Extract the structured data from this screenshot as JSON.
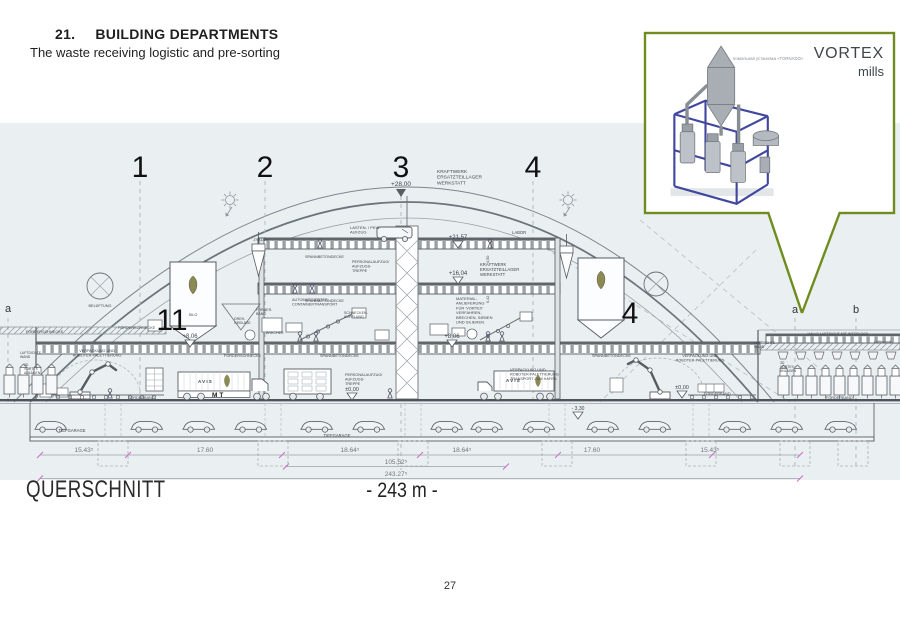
{
  "header": {
    "section_number": "21.",
    "title": "BUILDING DEPARTMENTS",
    "subtitle": "The waste receiving logistic and pre-sorting"
  },
  "inset": {
    "caption": "помольная установка «TORNADO»",
    "brand": "VORTEX",
    "brand_sub": "mills"
  },
  "titles": {
    "drawing_title": "QUERSCHNITT",
    "span_label": "- 243 m -"
  },
  "footer": {
    "page_number": "27"
  },
  "colors": {
    "callout_green": "#6f8d1f",
    "band_blue": "#eaeff2",
    "frame_blue": "#41479e",
    "tick_magenta": "#c96fc9"
  },
  "drawing": {
    "grid_labels": [
      {
        "t": "1",
        "x": 140,
        "y": 177,
        "s": 30,
        "a": "middle",
        "c": "#111"
      },
      {
        "t": "2",
        "x": 265,
        "y": 177,
        "s": 30,
        "a": "middle",
        "c": "#111"
      },
      {
        "t": "3",
        "x": 401,
        "y": 177,
        "s": 30,
        "a": "middle",
        "c": "#111"
      },
      {
        "t": "4",
        "x": 533,
        "y": 177,
        "s": 30,
        "a": "middle",
        "c": "#111"
      },
      {
        "t": "11",
        "x": 172,
        "y": 330,
        "s": 30,
        "a": "middle",
        "c": "#111"
      },
      {
        "t": "4",
        "x": 630,
        "y": 323,
        "s": 30,
        "a": "middle",
        "c": "#111"
      },
      {
        "t": "a",
        "x": 8,
        "y": 312,
        "s": 11,
        "a": "middle",
        "c": "#333"
      },
      {
        "t": "a",
        "x": 795,
        "y": 313,
        "s": 11,
        "a": "middle",
        "c": "#333"
      },
      {
        "t": "b",
        "x": 856,
        "y": 313,
        "s": 11,
        "a": "middle",
        "c": "#333"
      }
    ],
    "elevation_labels": [
      {
        "t": "+28,00",
        "x": 401,
        "y": 186,
        "s": 6.5,
        "a": "middle"
      },
      {
        "t": "+21,57",
        "x": 458,
        "y": 239,
        "s": 6,
        "a": "middle"
      },
      {
        "t": "+16,04",
        "x": 458,
        "y": 275,
        "s": 6,
        "a": "middle"
      },
      {
        "t": "+8,06",
        "x": 190,
        "y": 338,
        "s": 6,
        "a": "middle"
      },
      {
        "t": "+8,06",
        "x": 452,
        "y": 338,
        "s": 6,
        "a": "middle"
      },
      {
        "t": "±0,00",
        "x": 352,
        "y": 391,
        "s": 5.5,
        "a": "middle"
      },
      {
        "t": "±0,00",
        "x": 682,
        "y": 389,
        "s": 5.5,
        "a": "middle"
      },
      {
        "t": "- 3,30",
        "x": 578,
        "y": 410,
        "s": 5,
        "a": "middle"
      }
    ],
    "room_labels": [
      {
        "t": "KRAFTWERK\nERSATZTEILLAGER\nWERKSTATT",
        "x": 437,
        "y": 173,
        "s": 4.8
      },
      {
        "t": "LASTEN- / PKW-\nAUFZUG",
        "x": 350,
        "y": 229,
        "s": 4
      },
      {
        "t": "LABOR",
        "x": 512,
        "y": 234,
        "s": 4.2
      },
      {
        "t": "SPANNBETONDECKE",
        "x": 305,
        "y": 258,
        "s": 3.8
      },
      {
        "t": "PERSONALAUFZUG/\nAUFZUGS-\nTREPPE",
        "x": 352,
        "y": 263,
        "s": 3.8
      },
      {
        "t": "KRAFTWERK\nERSATZTEILLAGER\nWERKSTATT",
        "x": 480,
        "y": 266,
        "s": 4.2
      },
      {
        "t": "SPANNBETONDECKE",
        "x": 305,
        "y": 302,
        "s": 3.8
      },
      {
        "t": "ZYKLON",
        "x": 261,
        "y": 241,
        "s": 3.8,
        "a": "middle"
      },
      {
        "t": "BELÜFTUNG",
        "x": 100,
        "y": 307,
        "s": 3.8,
        "a": "middle"
      },
      {
        "t": "SILO",
        "x": 193,
        "y": 316,
        "s": 3.8,
        "a": "middle"
      },
      {
        "t": "AUTOMATISIERTER\nCONTAINERTRANSPORT",
        "x": 292,
        "y": 301,
        "s": 3.8
      },
      {
        "t": "SCHNECKEN-\nKUPPLUNG",
        "x": 344,
        "y": 314,
        "s": 3.6
      },
      {
        "t": "FÖRDER-\nBAND",
        "x": 256,
        "y": 311,
        "s": 3.6
      },
      {
        "t": "DREH-\nGEBLÄSE",
        "x": 234,
        "y": 320,
        "s": 3.6
      },
      {
        "t": "BRECHER",
        "x": 266,
        "y": 334,
        "s": 3.6
      },
      {
        "t": "MATERIAL-\nANLIEFERUNG\nFÜR 'VORTEX'\nVERFAHREN,\nBRECHEN, SIEBEN\nUND SILIEREN.",
        "x": 456,
        "y": 300,
        "s": 4
      },
      {
        "t": "FÖRDERSCHNECKE",
        "x": 26,
        "y": 333,
        "s": 3.8
      },
      {
        "t": "FÖRDERSCHNECKE",
        "x": 118,
        "y": 329,
        "s": 3.8
      },
      {
        "t": "FÖRDERSCHNECKE",
        "x": 224,
        "y": 357,
        "s": 3.8
      },
      {
        "t": "SPANNBETONDECKE",
        "x": 320,
        "y": 357,
        "s": 3.8
      },
      {
        "t": "SPANNBETONDECKE",
        "x": 592,
        "y": 357,
        "s": 3.8
      },
      {
        "t": "VERPACKUNG UND\nROBOTER-PALETTIERUNG",
        "x": 97,
        "y": 352,
        "s": 3.8,
        "a": "middle"
      },
      {
        "t": "VERPACKUNG UND\nROBOTER-PALETTIERUNG",
        "x": 700,
        "y": 357,
        "s": 3.8,
        "a": "middle"
      },
      {
        "t": "VERPACKUNG UND\nROBOTER-PALETTIERUNG\nTRANSPORT ZUM HAFEN",
        "x": 510,
        "y": 371,
        "s": 3.8
      },
      {
        "t": "PERSONALAUFZUG/\nAUFZUGS-\nTREPPE",
        "x": 345,
        "y": 376,
        "s": 3.8
      },
      {
        "t": "FÖRDERBAND",
        "x": 128,
        "y": 399,
        "s": 3.8
      },
      {
        "t": "FÖRDERBAND",
        "x": 704,
        "y": 395,
        "s": 3.8
      },
      {
        "t": "FÖRDERBAND",
        "x": 826,
        "y": 399,
        "s": 3.8
      },
      {
        "t": "TIEFGARAGE",
        "x": 72,
        "y": 432,
        "s": 4.2,
        "a": "middle"
      },
      {
        "t": "TIEFGARAGE",
        "x": 337,
        "y": 437,
        "s": 4.2,
        "a": "middle"
      },
      {
        "t": "HALLE LUFTDICHT MIT INTERLOCK",
        "x": 838,
        "y": 335,
        "s": 3.6,
        "a": "middle"
      },
      {
        "t": "Lufttechnik",
        "x": 874,
        "y": 343,
        "s": 3.6
      },
      {
        "t": "LUFTDICHTE\nWAND",
        "x": 754,
        "y": 344,
        "s": 3.4
      },
      {
        "t": "LUFTDICHTE\nWAND",
        "x": 20,
        "y": 354,
        "s": 3.4
      },
      {
        "t": "3D\nVORTEX\nANLAGEN",
        "x": 780,
        "y": 364,
        "s": 3.4
      },
      {
        "t": "3D\nVORTEX\nANLAGEN",
        "x": 24,
        "y": 366,
        "s": 3.4
      },
      {
        "t": "AVIS",
        "x": 198,
        "y": 383,
        "s": 4.5,
        "ls": 1.2,
        "w": "bold"
      },
      {
        "t": "AVIS",
        "x": 506,
        "y": 382,
        "s": 4.5,
        "ls": 1.2,
        "w": "bold"
      },
      {
        "t": "MT",
        "x": 212,
        "y": 397,
        "s": 6.5,
        "w": "bold",
        "ls": 2,
        "c": "#1a1a1a"
      }
    ],
    "dimension_labels": [
      {
        "t": "15.43⁵",
        "x": 84,
        "y": 452,
        "s": 6.5,
        "a": "middle",
        "c": "#777"
      },
      {
        "t": "17.60",
        "x": 205,
        "y": 452,
        "s": 6.5,
        "a": "middle",
        "c": "#777"
      },
      {
        "t": "18.64⁵",
        "x": 350,
        "y": 452,
        "s": 6.5,
        "a": "middle",
        "c": "#777"
      },
      {
        "t": "18.64⁵",
        "x": 462,
        "y": 452,
        "s": 6.5,
        "a": "middle",
        "c": "#777"
      },
      {
        "t": "17.60",
        "x": 592,
        "y": 452,
        "s": 6.5,
        "a": "middle",
        "c": "#777"
      },
      {
        "t": "15.43⁵",
        "x": 710,
        "y": 452,
        "s": 6.5,
        "a": "middle",
        "c": "#777"
      },
      {
        "t": "105.52⁵",
        "x": 396,
        "y": 464,
        "s": 6.5,
        "a": "middle",
        "c": "#777"
      },
      {
        "t": "243.27⁵",
        "x": 396,
        "y": 476,
        "s": 6.5,
        "a": "middle",
        "c": "#777"
      },
      {
        "t": "4,50",
        "x": 489,
        "y": 263,
        "s": 3.8,
        "r": -90
      },
      {
        "t": "5,42",
        "x": 489,
        "y": 303,
        "s": 3.8,
        "r": -90
      }
    ]
  }
}
